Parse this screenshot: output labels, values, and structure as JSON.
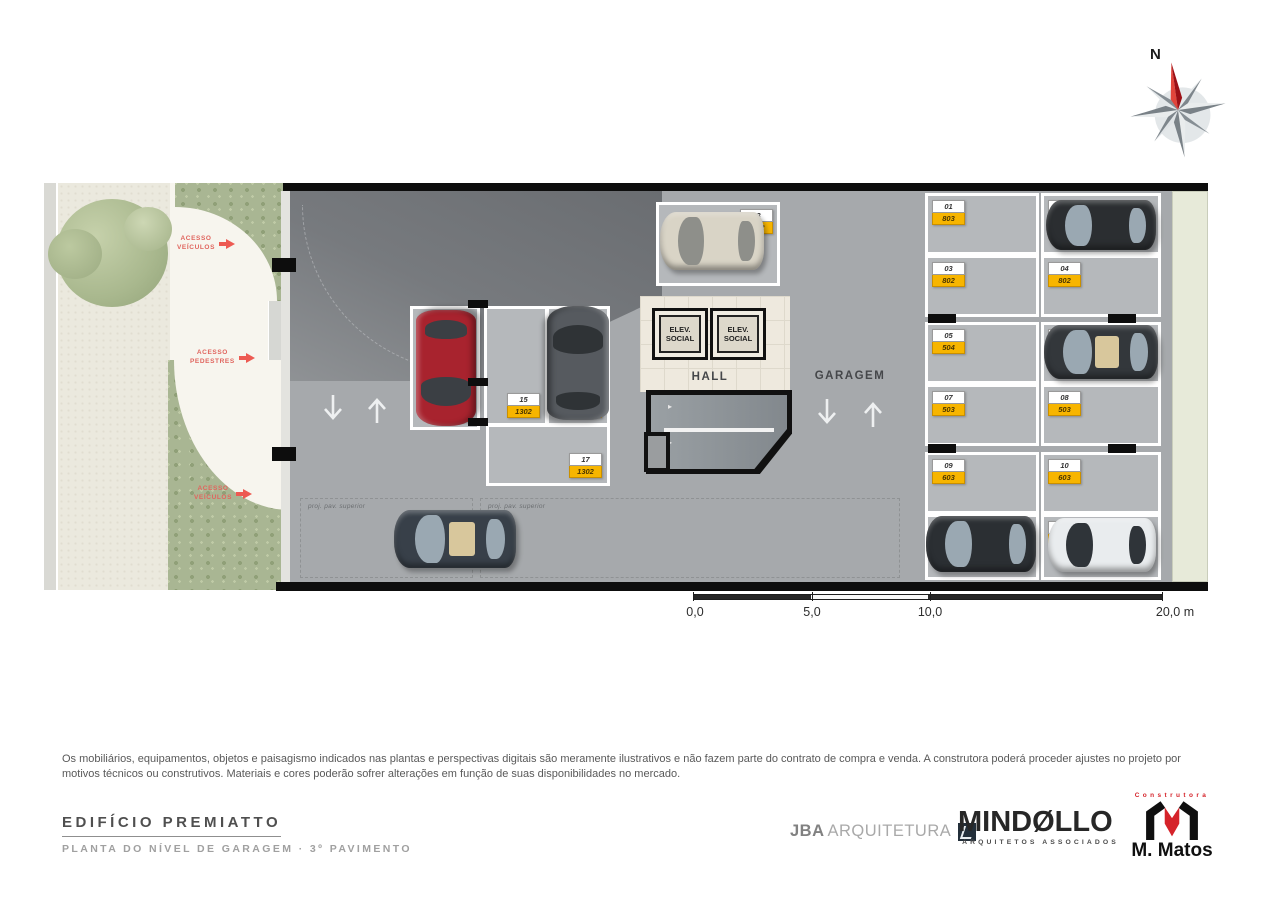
{
  "compass": {
    "north_label": "N"
  },
  "plan": {
    "labels": {
      "hall": "HALL",
      "garagem": "GARAGEM",
      "elev_line1": "ELEV.",
      "elev_line2": "SOCIAL",
      "proj_pav_superior": "proj. pav. superior",
      "acesso": "ACESSO",
      "veiculos": "VEÍCULOS",
      "pedestres": "PEDESTRES"
    },
    "spaces": [
      {
        "num": "01",
        "unit": "803"
      },
      {
        "num": "02",
        "unit": "803"
      },
      {
        "num": "03",
        "unit": "802"
      },
      {
        "num": "04",
        "unit": "802"
      },
      {
        "num": "05",
        "unit": "504"
      },
      {
        "num": "06",
        "unit": "504"
      },
      {
        "num": "07",
        "unit": "503"
      },
      {
        "num": "08",
        "unit": "503"
      },
      {
        "num": "09",
        "unit": "603"
      },
      {
        "num": "10",
        "unit": "603"
      },
      {
        "num": "11",
        "unit": "801"
      },
      {
        "num": "12",
        "unit": "801"
      },
      {
        "num": "13",
        "unit": "1102"
      },
      {
        "num": "14",
        "unit": "1102"
      },
      {
        "num": "15",
        "unit": "1302"
      },
      {
        "num": "16",
        "unit": "1302"
      },
      {
        "num": "17",
        "unit": "1302"
      }
    ]
  },
  "scalebar": {
    "ticks": [
      "0,0",
      "5,0",
      "10,0",
      "20,0 m"
    ]
  },
  "disclaimer": "Os mobiliários, equipamentos, objetos e paisagismo indicados nas plantas e perspectivas digitais são meramente ilustrativos e não fazem parte do contrato de compra e venda. A construtora poderá proceder ajustes no projeto por motivos técnicos ou construtivos. Materiais e cores poderão  sofrer  alterações em função de suas disponibilidades no mercado.",
  "footer": {
    "project_title": "EDIFÍCIO PREMIATTO",
    "plan_subtitle": "PLANTA DO NÍVEL DE GARAGEM · 3º PAVIMENTO",
    "jba": {
      "name": "JBA",
      "suffix": "ARQUITETURA"
    },
    "mindello": {
      "name": "MINDØLLO",
      "subtitle": "ARQUITETOS ASSOCIADOS"
    },
    "mmatos": {
      "tagline": "Construtora",
      "name": "M. Matos"
    }
  },
  "colors": {
    "badge_yellow": "#f7b500",
    "accent_red": "#ed5a52",
    "wall_black": "#0d0d0d",
    "floor_gray": "#a6a9ac",
    "space_gray": "#b5b8bb",
    "garden_beige": "#f5f3ec",
    "green_strip": "#e7ead9",
    "foliage_green": "#a9b693",
    "car_red": "#a8232e",
    "car_dark": "#2e3134",
    "car_white": "#e9ecee",
    "car_beige": "#d9d4c6",
    "mmatos_red": "#d5232a"
  }
}
